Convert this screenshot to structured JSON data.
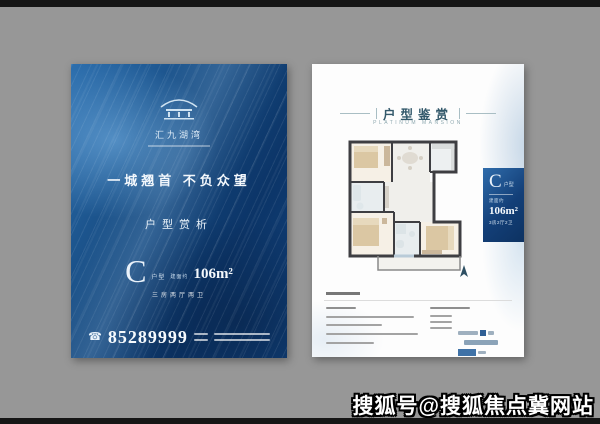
{
  "watermark": {
    "text": "搜狐号@搜狐焦点冀网站"
  },
  "left_poster": {
    "logo_name": "汇九湖湾",
    "slogan": "一城翘首  不负众望",
    "section_title": "户型赏析",
    "unit_letter": "C",
    "unit_type": "户型",
    "area_note": "建面约",
    "area": "106m²",
    "rooms": "三房两厅两卫",
    "phone": "85289999"
  },
  "right_poster": {
    "header_title": "户型鉴赏",
    "header_subtitle": "PLATINUM MANSION",
    "badge_letter": "C",
    "badge_type": "户型",
    "badge_area_note": "建面约",
    "badge_area": "106m²",
    "badge_rooms": "3房2厅2卫"
  },
  "icons": {
    "logo": "pavilion-icon",
    "phone": "phone-icon",
    "north": "north-arrow-icon"
  },
  "colors": {
    "background_gray": "#979797",
    "poster_blue": "#15497f",
    "badge_blue": "#133f78",
    "header_teal": "#33596b",
    "watercolor_blue": "#a5c5e0",
    "wall_dark": "#3e3e42",
    "furniture_beige": "#dbc7a3"
  }
}
